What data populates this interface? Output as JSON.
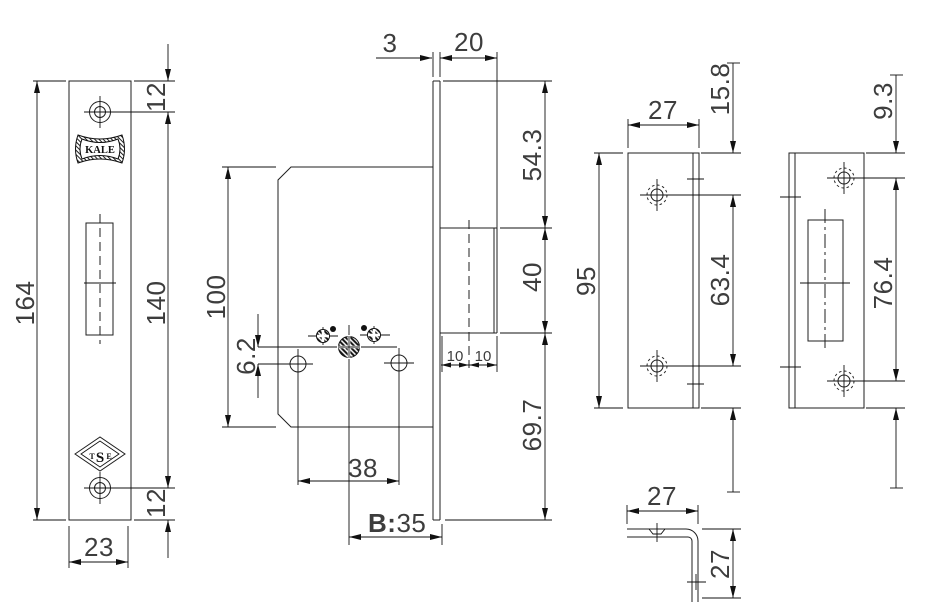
{
  "drawing": {
    "faceplate_view": {
      "height": "164",
      "top_hole_offset": "12",
      "hole_spacing": "140",
      "bottom_hole_offset": "12",
      "width": "23",
      "brand": "KALE",
      "cert": {
        "t": "T",
        "s": "S",
        "e": "E"
      }
    },
    "body_view": {
      "body_height": "100",
      "cylinder_to_holes": "6.2",
      "hole_spacing": "38",
      "backset_prefix": "B:",
      "backset_value": "35",
      "faceplate_thickness": "3",
      "bolt_throw": "20",
      "top_section": "54.3",
      "bolt_height": "40",
      "bolt_inner": "10",
      "bolt_outer": "10",
      "bottom_section": "69.7"
    },
    "strike_plain_view": {
      "width": "27",
      "height": "95",
      "top_hole_offset": "15.8",
      "hole_spacing": "63.4",
      "bottom_hole_offset": "15.8"
    },
    "strike_slotted_view": {
      "top_hole_offset": "9.3",
      "hole_spacing": "76.4",
      "bottom_hole_offset": "9.3"
    },
    "angle_view": {
      "width": "27",
      "height": "27"
    }
  }
}
